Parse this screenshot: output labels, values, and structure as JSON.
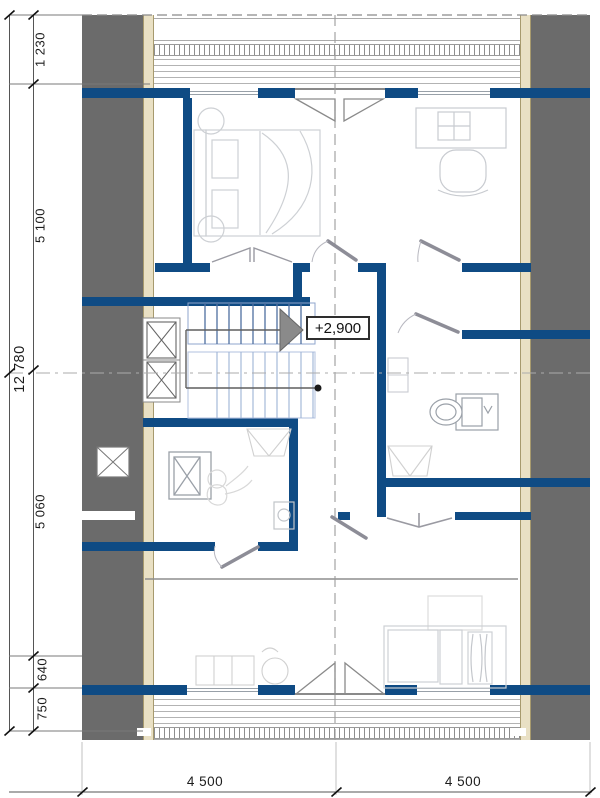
{
  "annotations": {
    "level": "+2,900"
  },
  "dimensions": {
    "left_total": "12 780",
    "left_segments": [
      "1 230",
      "5 100",
      "5 060",
      "640",
      "750"
    ],
    "bottom_segments": [
      "4 500",
      "4 500"
    ]
  },
  "icons": {
    "stair_direction": "right-filled-triangle-arrow",
    "window_cross": "x-cross-window",
    "french_door": "double-triangle-door-swing",
    "skylight": "x-cross-skylight"
  },
  "colors": {
    "wall": "#0f4b84",
    "roof_overhang": "#6b6b6b",
    "timber_cladding": "#e9e0c4",
    "stair_tread": "#4f6fa0",
    "stair_tread_light": "#9db3d6",
    "door_leaf": "#8d8d97",
    "dimension_text": "#1c1c1c"
  }
}
